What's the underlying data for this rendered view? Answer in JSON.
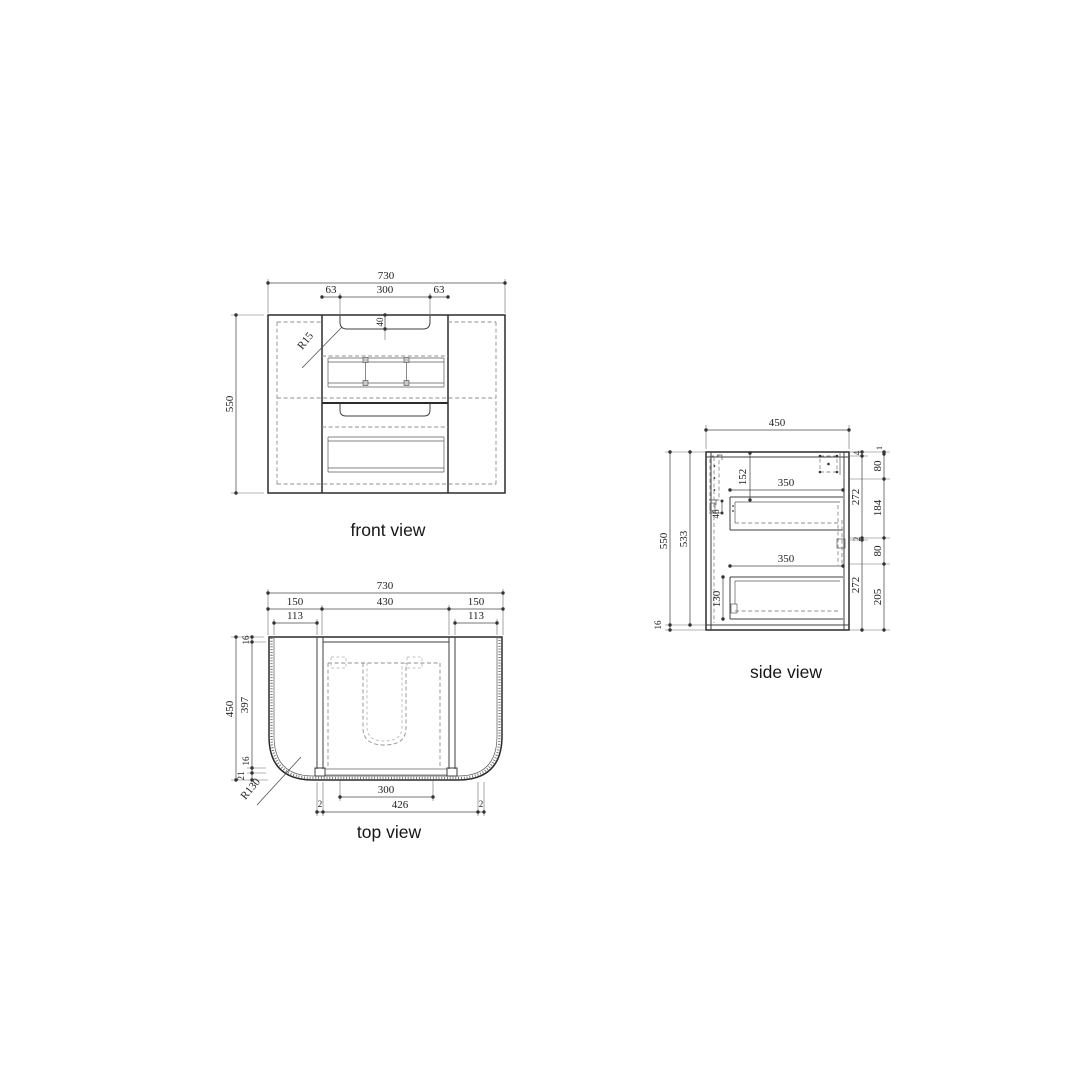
{
  "colors": {
    "line": "#2b2b2b",
    "dimension": "#4a4a4a",
    "hidden": "#8f8f8f",
    "text": "#222222",
    "background": "#ffffff"
  },
  "front": {
    "label": "front view",
    "d730": "730",
    "d63a": "63",
    "d300": "300",
    "d63b": "63",
    "d40": "40",
    "r15": "R15",
    "d550": "550"
  },
  "topview": {
    "label": "top view",
    "d730": "730",
    "d150a": "150",
    "d430": "430",
    "d150b": "150",
    "d113a": "113",
    "d113b": "113",
    "d450": "450",
    "d16a": "16",
    "d397": "397",
    "d16b": "16",
    "d21": "21",
    "r130": "R130",
    "d300": "300",
    "d2a": "2",
    "d426": "426",
    "d2b": "2"
  },
  "side": {
    "label": "side view",
    "d450": "450",
    "d550": "550",
    "d533": "533",
    "d16": "16",
    "d152": "152",
    "d46": "46",
    "d350a": "350",
    "d350b": "350",
    "d130": "130",
    "i4": "4",
    "i272a": "272",
    "i2": "2",
    "i272b": "272",
    "o1": "1",
    "o80a": "80",
    "o184": "184",
    "o80b": "80",
    "o205": "205"
  }
}
